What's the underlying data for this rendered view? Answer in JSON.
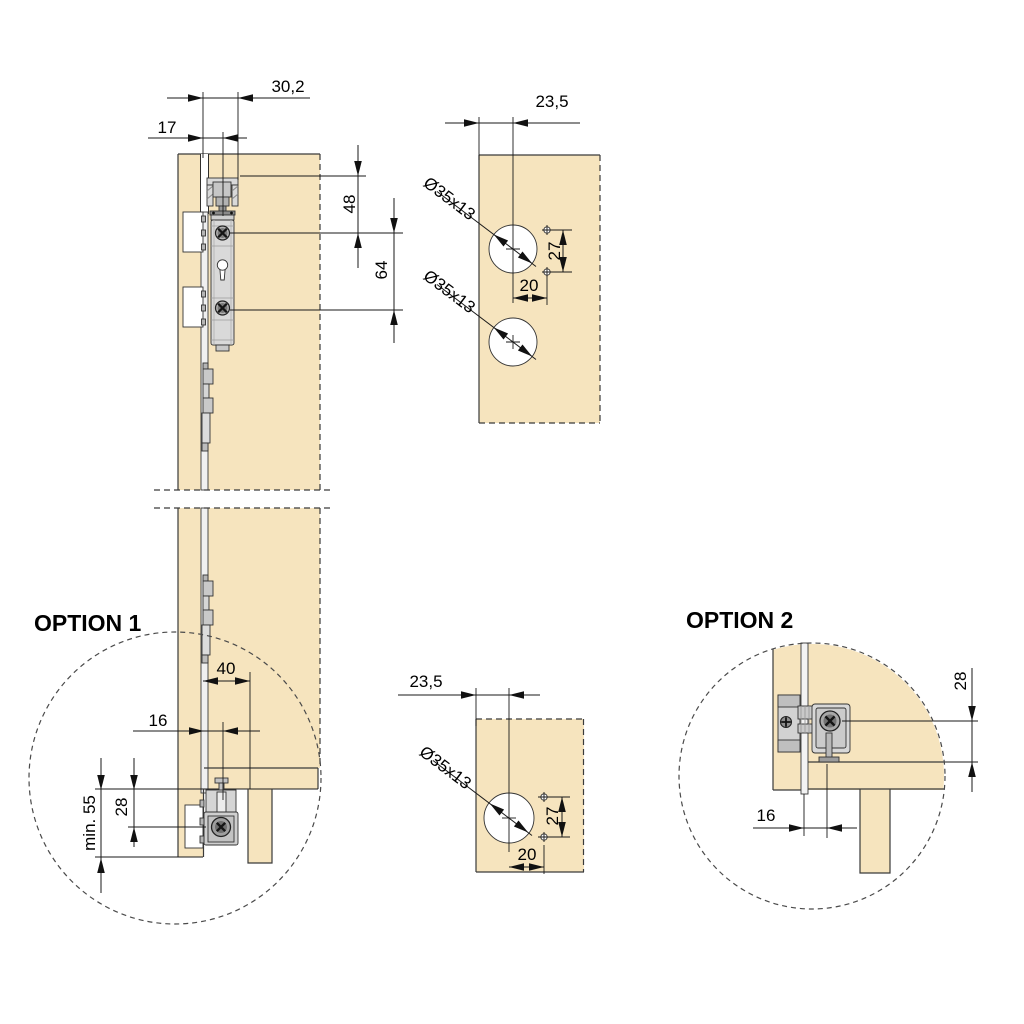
{
  "drawing": {
    "main_section": {
      "dim_track_width": "30,2",
      "dim_front_offset": "17",
      "dim_top_to_hole1": "48",
      "dim_hole_spacing": "64"
    },
    "drill_template_top": {
      "dim_edge_offset": "23,5",
      "hole1_label": "Ø35x13",
      "hole2_label": "Ø35x13",
      "dim_screw_spacing": "27",
      "dim_screw_offset": "20"
    },
    "drill_template_bottom": {
      "dim_edge_offset": "23,5",
      "hole_label": "Ø35x13",
      "dim_screw_spacing": "27",
      "dim_screw_offset": "20"
    },
    "option1": {
      "title": "OPTION 1",
      "dim_depth": "40",
      "dim_front_offset": "16",
      "dim_min_clearance": "min. 55",
      "dim_bracket_height": "28"
    },
    "option2": {
      "title": "OPTION 2",
      "dim_front_offset": "16",
      "dim_bracket_height": "28"
    }
  },
  "colors": {
    "panel": "#F6E4BE",
    "outline": "#3a3a3a",
    "dimension": "#1a1a1a",
    "hardware_light": "#d9d9d9",
    "hardware_mid": "#bdbdbd",
    "hardware_dark": "#8a8a8a",
    "background": "#ffffff"
  }
}
